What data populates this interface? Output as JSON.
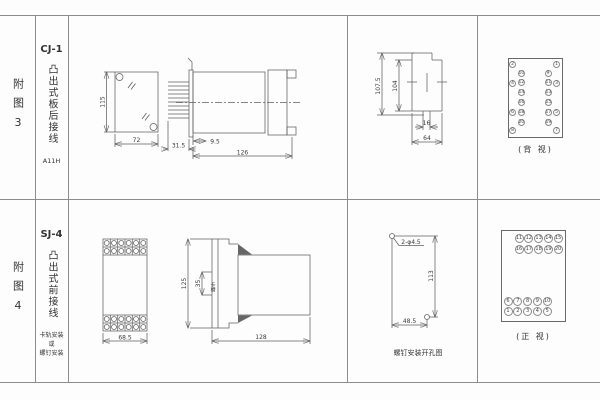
{
  "figure3": {
    "index_label": "附图3",
    "model": "CJ-1",
    "wiring_type": "凸出式板后接线",
    "code": "A11H",
    "front": {
      "height": "115",
      "width": "72"
    },
    "side": {
      "pin_depth": "31.5",
      "panel_gap": "9.5",
      "length": "126"
    },
    "cutout": {
      "total_height": "107.5",
      "inner_height": "104",
      "tab_width": "16",
      "width": "64"
    },
    "rear_terminals": {
      "caption": "(背 视)",
      "left_outer": [
        "2",
        "4",
        "6",
        "8"
      ],
      "left_inner": [
        "10",
        "12",
        "14",
        "16",
        "18",
        "20"
      ],
      "right_outer": [
        "1",
        "3",
        "5",
        "7"
      ],
      "right_inner": [
        "9",
        "11",
        "13",
        "15",
        "17",
        "19"
      ]
    }
  },
  "figure4": {
    "index_label": "附图4",
    "model": "SJ-4",
    "wiring_type": "凸出式前接线",
    "mount_note_line1": "卡轨安装",
    "mount_note_line2": "或",
    "mount_note_line3": "螺钉安装",
    "front": {
      "width": "68.5"
    },
    "side": {
      "height": "125",
      "slot": "35",
      "slot_label": "卡槽",
      "length": "128"
    },
    "drill": {
      "caption": "螺钉安装开孔图",
      "holes": "2-φ4.5",
      "height": "113",
      "width": "48.5"
    },
    "front_terminals": {
      "caption": "(正 视)",
      "row1": [
        "11",
        "12",
        "13",
        "14",
        "15"
      ],
      "row2": [
        "16",
        "17",
        "18",
        "19",
        "20"
      ],
      "row3": [
        "6",
        "7",
        "8",
        "9",
        "10"
      ],
      "row4": [
        "1",
        "2",
        "3",
        "4",
        "5"
      ]
    }
  }
}
